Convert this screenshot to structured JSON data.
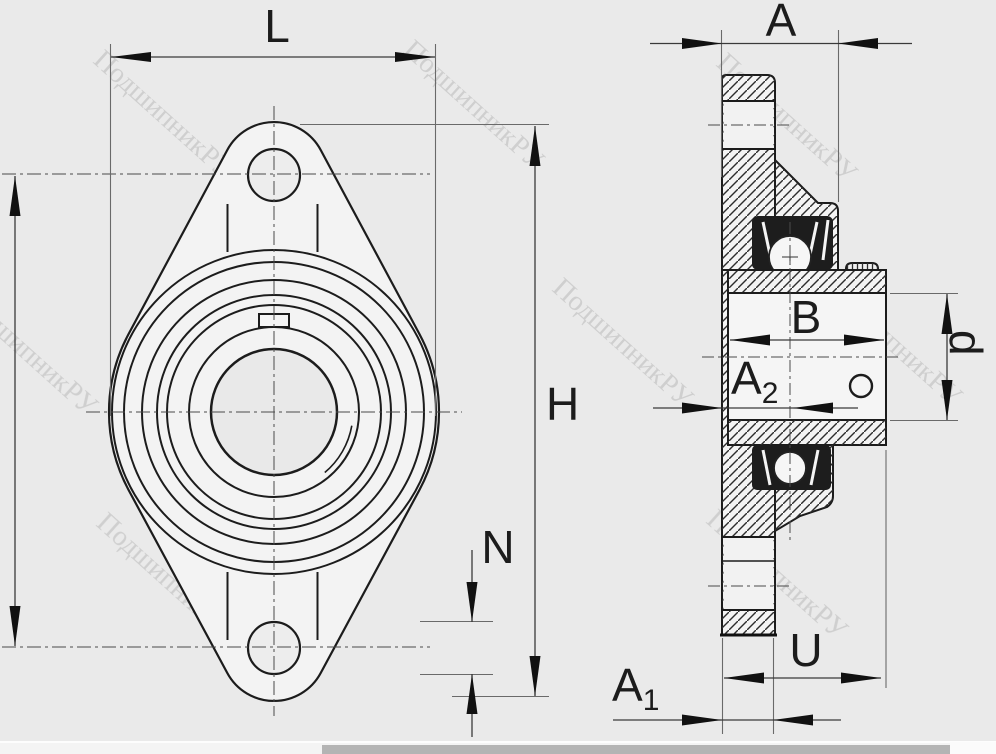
{
  "drawing": {
    "type": "two-view technical drawing of an oval flange bearing unit (UCFL type)",
    "views": {
      "front_view": "oval two-bolt flange with concentric bearing circles",
      "side_view": "sectioned flange with bearing, collar and set screw"
    }
  },
  "dims": {
    "flange_width_label": "L",
    "unit_width_label": "A",
    "flange_height_label": "H",
    "bolt_hole_label": "N",
    "ring_width_label": "B",
    "a2_base": "A",
    "a2_sub": "2",
    "bore_label": "d",
    "u_label": "U",
    "a1_base": "A",
    "a1_sub": "1"
  },
  "watermark": {
    "text": "ПодшипникРУ",
    "color": "#b5b5b5"
  },
  "colors": {
    "background": "#eaeaea",
    "line": "#1c1c1c",
    "dimension_line": "#3a3a3a",
    "fill_light": "#f4f4f4",
    "seal_dark": "#1d1d1d",
    "scrollbar_thumb": "#b4b4b4"
  },
  "scrollbar": {
    "horizontal_visible": true
  }
}
